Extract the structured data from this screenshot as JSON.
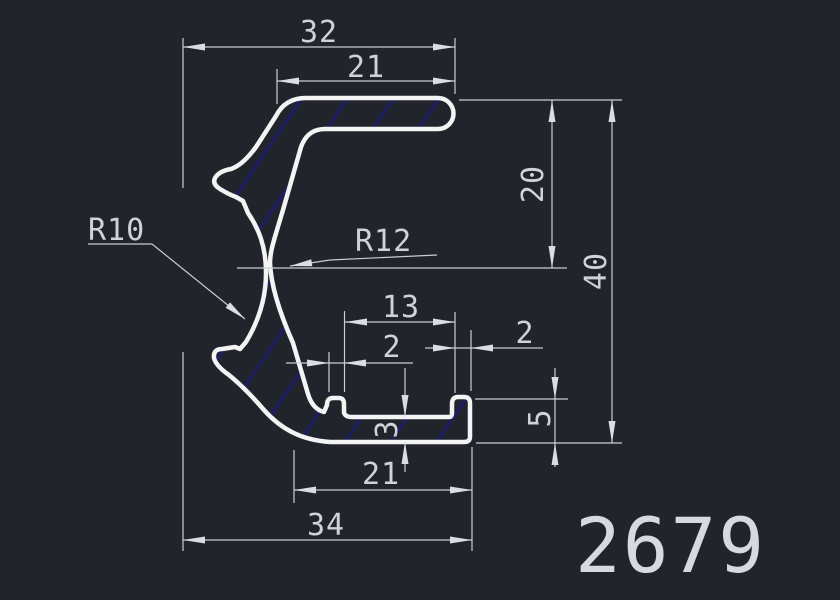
{
  "drawing": {
    "part_number": "2679",
    "dims": {
      "top_overall": "32",
      "top_arm": "21",
      "upper_height": "20",
      "overall_height": "40",
      "slot": "13",
      "tab_left": "2",
      "tab_right": "2",
      "lip_height": "5",
      "base_thickness": "3",
      "base_span": "21",
      "bottom_overall": "34"
    },
    "radii": {
      "r_left": "R10",
      "r_inner": "R12"
    },
    "colors": {
      "background": "#21242b",
      "outline": "#f4f4f4",
      "hatch": "#1c1c74",
      "dimension": "#c9ced2",
      "text": "#ced3d7"
    }
  }
}
